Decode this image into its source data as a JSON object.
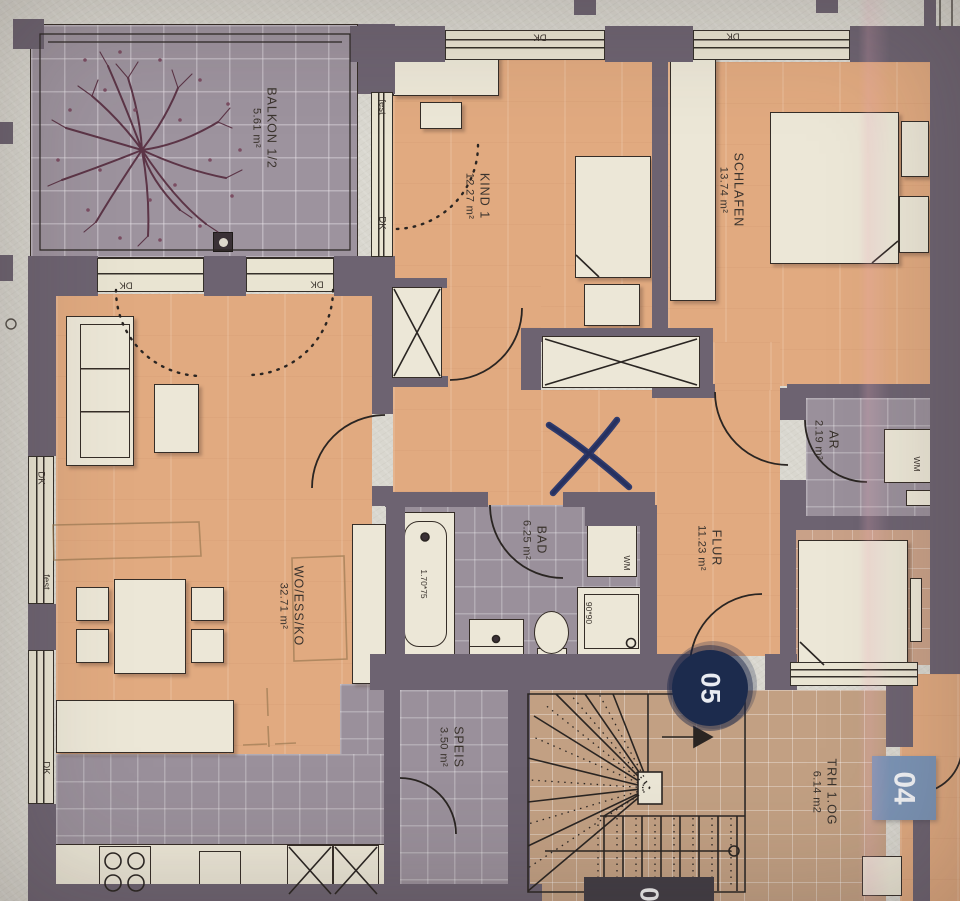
{
  "unit_badges": {
    "circle_unit": "05",
    "square_unit": "04",
    "edge_unit_partial": "0"
  },
  "rooms": [
    {
      "name": "BALKON 1/2",
      "area": "5.61 m²"
    },
    {
      "name": "KIND 1",
      "area": "12.27 m²"
    },
    {
      "name": "SCHLAFEN",
      "area": "13.74 m²"
    },
    {
      "name": "WO/ESS/KO",
      "area": "32.71 m²"
    },
    {
      "name": "BAD",
      "area": "6.25 m²"
    },
    {
      "name": "FLUR",
      "area": "11.23 m²"
    },
    {
      "name": "AR",
      "area": "2.19 m²"
    },
    {
      "name": "SPEIS",
      "area": "3.50 m²"
    },
    {
      "name": "TRH 1.OG",
      "area": "6.14 m2"
    }
  ],
  "window_labels": {
    "tilt": "DK",
    "fixed": "fest"
  },
  "appliance_labels": {
    "washing_machine": "WM"
  },
  "fixture_dimensions": {
    "bathtub": "1.70*75",
    "shower": "90*90"
  },
  "colors": {
    "paper": "#d9d7cf",
    "wall": "#6d6371",
    "floor_orange": "#e1aa80",
    "tile_gray": "#9a909b",
    "stair_tan": "#c2a083",
    "furniture_cream": "#ece7d7",
    "badge_navy": "#1c2b4d",
    "badge_blue": "#7b94b6",
    "ink_blue": "#2f3b6d"
  }
}
